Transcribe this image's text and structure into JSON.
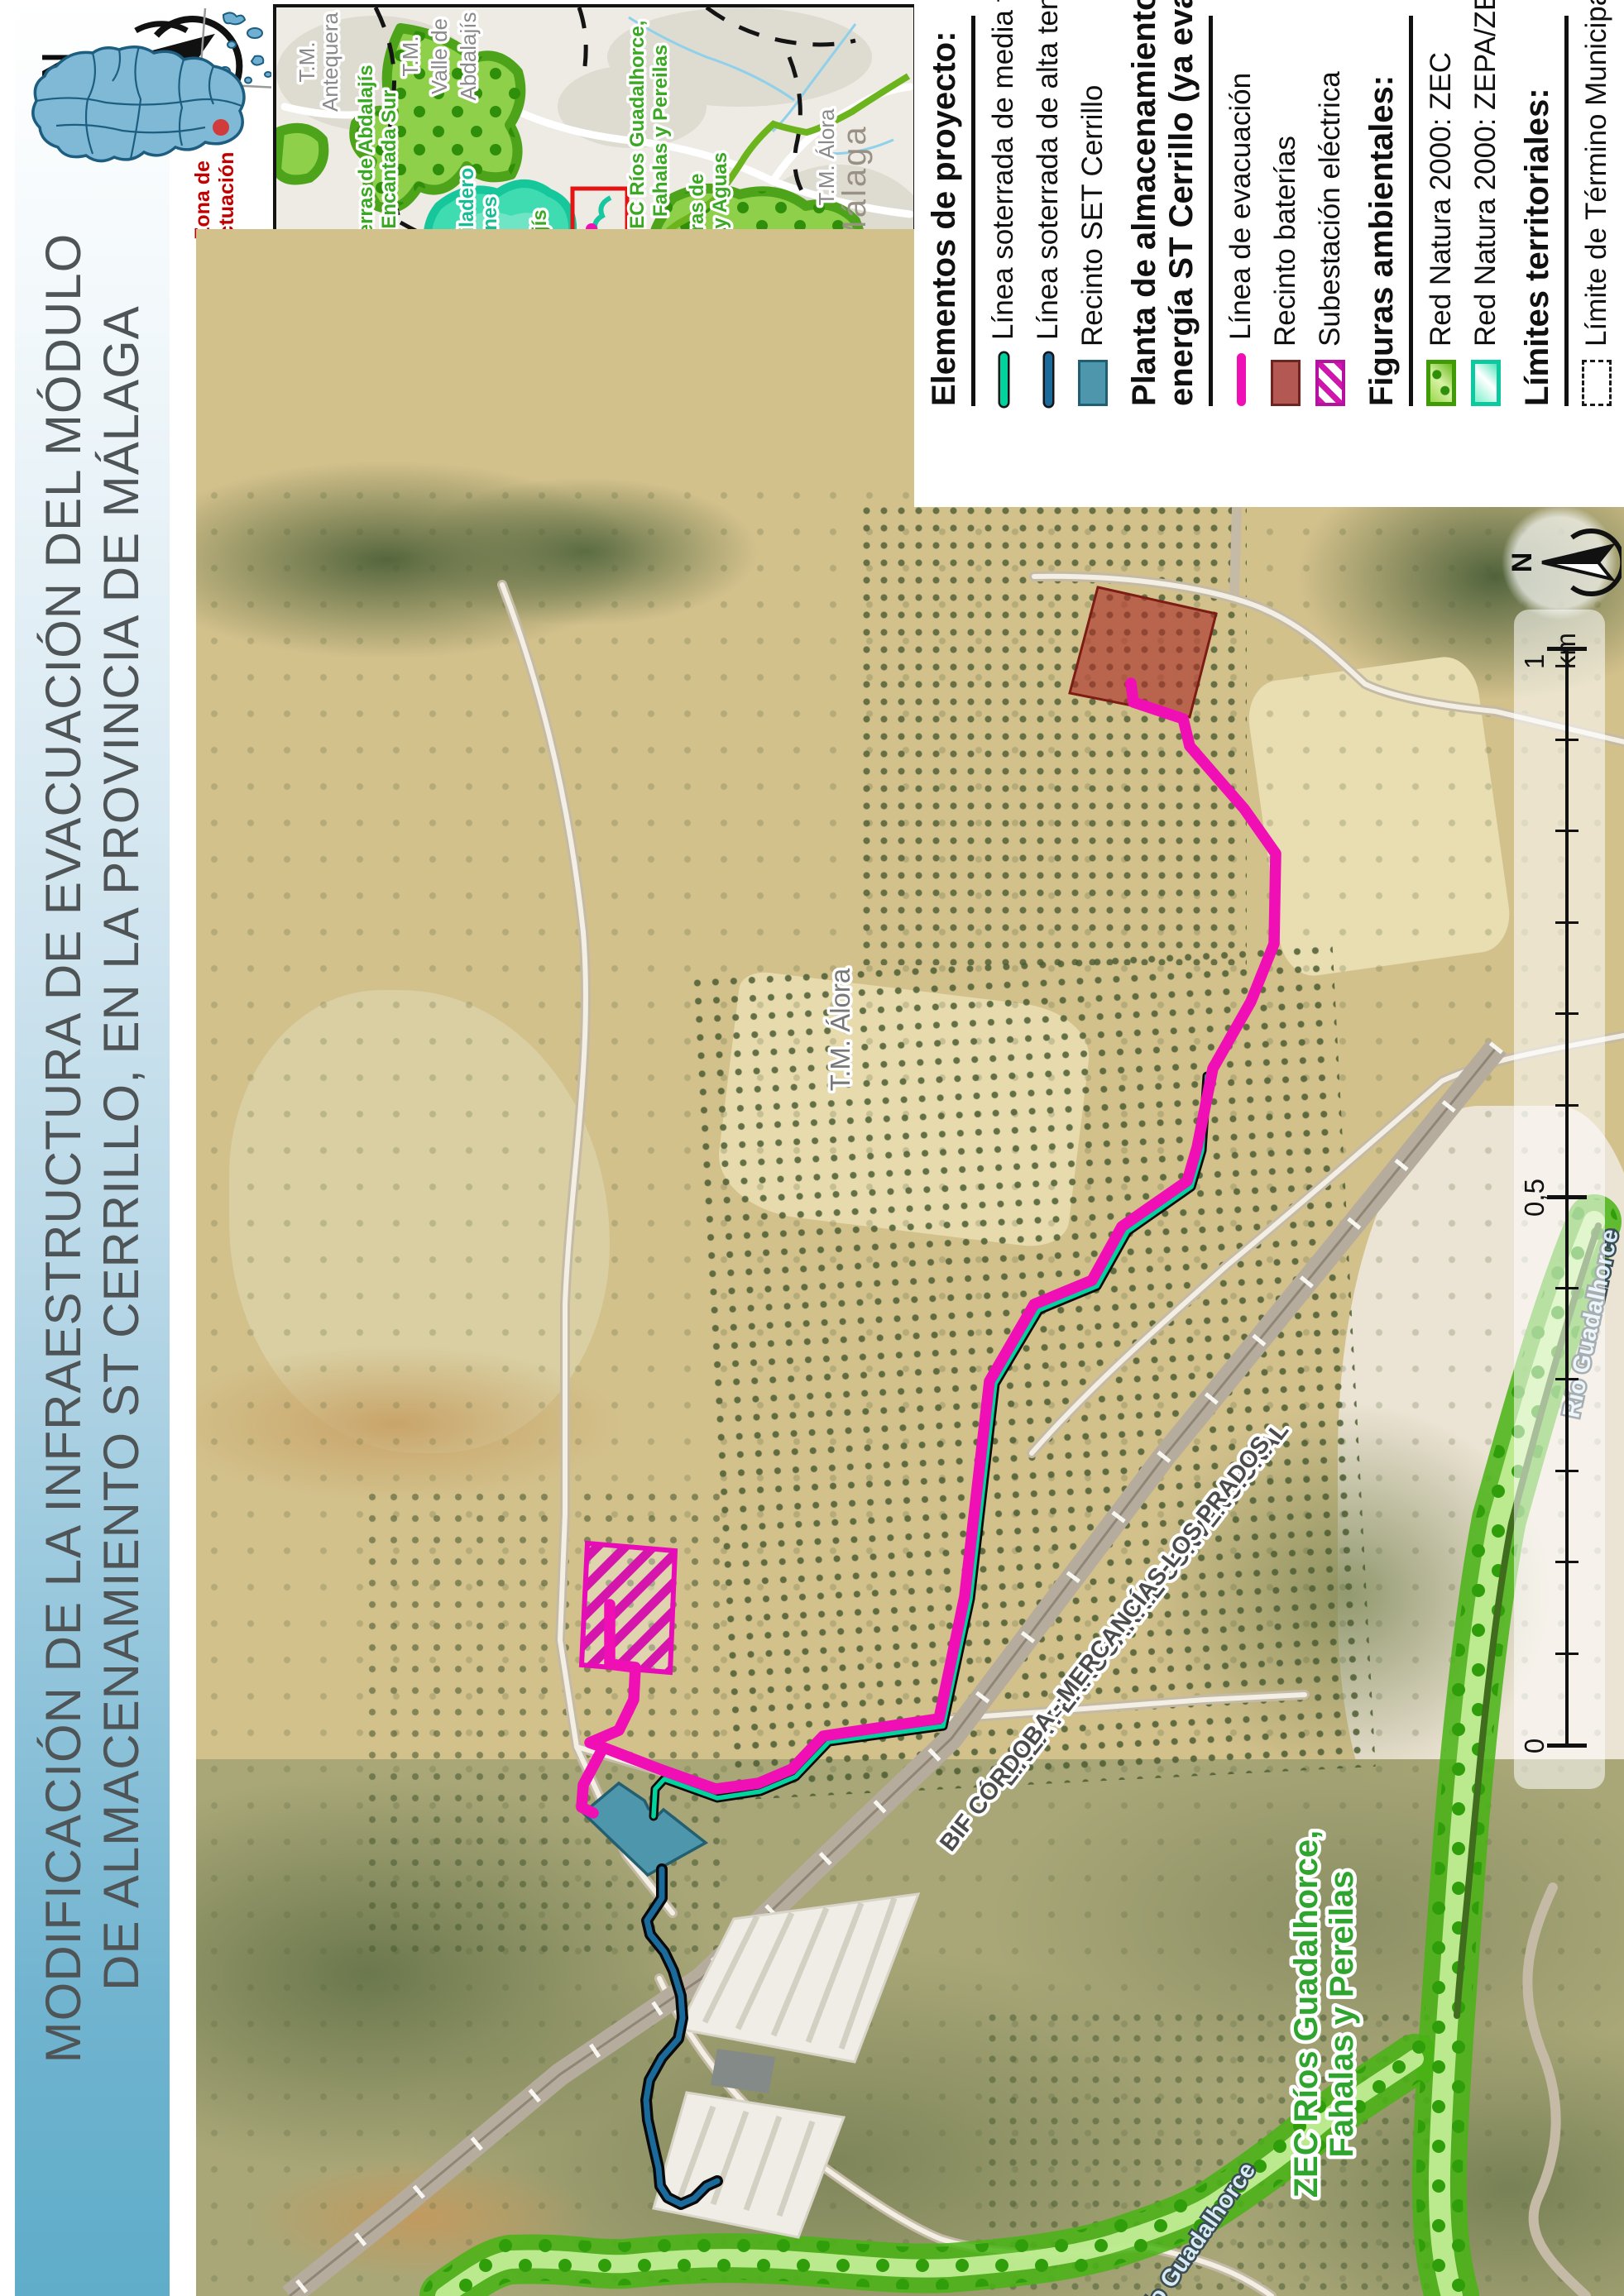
{
  "title": {
    "line1": "MODIFICACIÓN DE LA INFRAESTRUCTURA DE EVACUACIÓN DEL MÓDULO",
    "line2": "DE ALMACENAMIENTO ST CERRILLO, EN LA PROVINCIA DE MÁLAGA"
  },
  "zona": {
    "line1": "Zona de",
    "line2": "actuación"
  },
  "compass": {
    "n": "N"
  },
  "map_north": {
    "n": "N"
  },
  "inset": {
    "labels": {
      "tm_antequera_1": "T.M.",
      "tm_antequera_2": "Antequera",
      "tm_valle_1": "T.M.",
      "tm_valle_2": "Valle de",
      "tm_valle_3": "Abdalajís",
      "tm_campillos_1": "T.M.",
      "tm_campillos_2": "Campillos",
      "tm_ardales": "T.M. Ardales",
      "tm_alora": "T.M. Álora",
      "malaga": "Málaga",
      "tm_casarabonela_1": "T.M.",
      "tm_casarabonela_2": "Casarabonela",
      "tm_carratraca": "T.M. Carratraca",
      "zec_abdalajis_n_1": "ZEC Sierras de Abdalajís",
      "zec_abdalajis_n_2": "y La Encantada Sur",
      "zepa_gaitanes_1": "ZEPA/ZEC Desfiladero",
      "zepa_gaitanes_2": "de Los Gaitanes",
      "zec_abdalajis_s_1": "ZEC Sierras de Abdalajís",
      "zec_abdalajis_s_2": "y La Encantada Sur",
      "zec_rios_1": "ZEC Ríos Guadalhorce,",
      "zec_rios_2": "Fahalas y Pereilas",
      "zec_alcaparain_1": "ZEC Sierras de",
      "zec_alcaparain_2": "Alcaparaín y Aguas"
    }
  },
  "legend": {
    "s0": {
      "title": "Elementos de proyecto:",
      "i0": "Línea soterrada de media tensión",
      "i1": "Línea soterrada de alta tensión",
      "i2": "Recinto SET Cerrillo"
    },
    "s1": {
      "t1": "Planta de almacenamiento de",
      "t2": "energía ST Cerrillo (ya evaluada)",
      "i0": "Línea de evacuación",
      "i1": "Recinto baterías",
      "i2": "Subestación eléctrica"
    },
    "s2": {
      "title": "Figuras ambientales:",
      "i0": "Red Natura 2000: ZEC",
      "i1": "Red Natura 2000: ZEPA/ZEC"
    },
    "s3": {
      "title": "Límites territoriales:",
      "i0": "Límite de Término Municipal"
    }
  },
  "map": {
    "labels": {
      "tm_alora": "T.M. Álora",
      "rail1": "LÍNEA FERROCARRIL CONVENCIONAL",
      "rail2": "BIF CÓRDOBA - MERCANCÍAS-LOS PRADOS",
      "zec_line1": "ZEC Ríos Guadalhorce,",
      "zec_line2": "Fahalas y Pereilas",
      "rio_right": "Río Guadalhorce",
      "rio_bottom": "Río Guadalhorce"
    },
    "scalebar": {
      "zero": "0",
      "half": "0,5",
      "one": "1 km"
    }
  },
  "colors": {
    "banner_blue": "#5fadc9",
    "zona_red": "#c00000",
    "evacuation_line": "#f00fb4",
    "media_tension_line": "#00d39e",
    "alta_tension_line": "#1a6a9c",
    "set_fill": "#4e96ac",
    "baterias_fill": "#b45853",
    "subestacion_magenta": "#cf17ad",
    "zec_green": "#52b41e",
    "zepa_teal": "#2fdcb2"
  }
}
